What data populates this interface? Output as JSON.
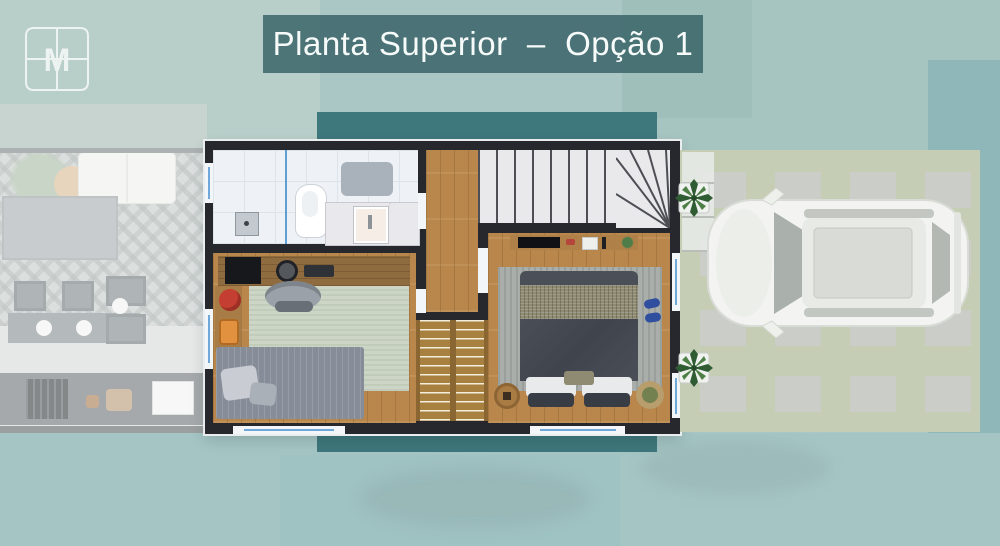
{
  "banner": {
    "title": "Planta Superior  –  Opção 1"
  },
  "logo": {
    "letter": "M"
  },
  "palette": {
    "banner_bg": "#3a6468",
    "accent_band": "#3e777c",
    "background": "#abc7c5",
    "wall": "#26282e",
    "wood_floor": "#b9874c",
    "marble_stair": "#e9e9ec",
    "grass": "#c5ceb5",
    "window_glass": "#6fa7d8"
  },
  "plan_regions": [
    "bathroom",
    "hallway",
    "staircase",
    "staircase-winder",
    "office-bedroom",
    "master-bedroom",
    "void-wood-slats",
    "driveway",
    "ground-floor-faded"
  ]
}
